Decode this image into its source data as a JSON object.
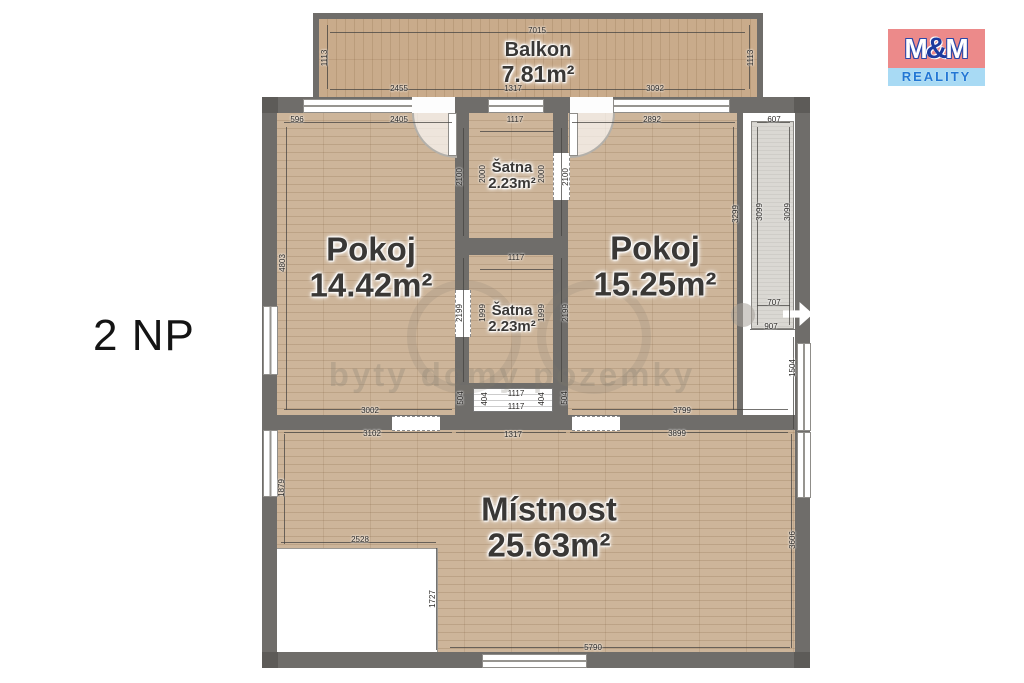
{
  "floor_label": "2 NP",
  "logo": {
    "m1": "M",
    "amp": "&",
    "m2": "M",
    "reality": "REALITY"
  },
  "watermark": "byty domy pozemky",
  "rooms": {
    "balkon": {
      "name": "Balkon",
      "area": "7.81m²"
    },
    "pokoj_left": {
      "name": "Pokoj",
      "area": "14.42m²"
    },
    "satna_top": {
      "name": "Šatna",
      "area": "2.23m²"
    },
    "satna_bottom": {
      "name": "Šatna",
      "area": "2.23m²"
    },
    "pokoj_right": {
      "name": "Pokoj",
      "area": "15.25m²"
    },
    "mistnost": {
      "name": "Místnost",
      "area": "25.63m²"
    }
  },
  "colors": {
    "wall": "#6f6d6a",
    "wood": "#cdb59a",
    "balcony_wood": "#c9ab8b",
    "shaft": "#dad8d3",
    "logo_pink": "#ec8a8a",
    "logo_blue": "#a8daf4",
    "logo_text_blue": "#2277d4"
  },
  "dimensions": [
    {
      "text": "7015",
      "x": 537,
      "y": 31,
      "o": "h"
    },
    {
      "text": "1113",
      "x": 325,
      "y": 58,
      "o": "v"
    },
    {
      "text": "1113",
      "x": 751,
      "y": 58,
      "o": "v"
    },
    {
      "text": "2455",
      "x": 399,
      "y": 89,
      "o": "h"
    },
    {
      "text": "1317",
      "x": 513,
      "y": 89,
      "o": "h"
    },
    {
      "text": "3092",
      "x": 655,
      "y": 89,
      "o": "h"
    },
    {
      "text": "596",
      "x": 297,
      "y": 120,
      "o": "h"
    },
    {
      "text": "2405",
      "x": 399,
      "y": 120,
      "o": "h"
    },
    {
      "text": "1117",
      "x": 515,
      "y": 120,
      "o": "h"
    },
    {
      "text": "2892",
      "x": 652,
      "y": 120,
      "o": "h"
    },
    {
      "text": "607",
      "x": 774,
      "y": 120,
      "o": "h"
    },
    {
      "text": "4803",
      "x": 283,
      "y": 263,
      "o": "v"
    },
    {
      "text": "2100",
      "x": 460,
      "y": 177,
      "o": "v"
    },
    {
      "text": "2000",
      "x": 483,
      "y": 174,
      "o": "v"
    },
    {
      "text": "2000",
      "x": 542,
      "y": 174,
      "o": "v"
    },
    {
      "text": "2100",
      "x": 566,
      "y": 177,
      "o": "v"
    },
    {
      "text": "3299",
      "x": 736,
      "y": 214,
      "o": "v"
    },
    {
      "text": "3099",
      "x": 760,
      "y": 212,
      "o": "v"
    },
    {
      "text": "3099",
      "x": 788,
      "y": 212,
      "o": "v"
    },
    {
      "text": "1117",
      "x": 516,
      "y": 258,
      "o": "h"
    },
    {
      "text": "2199",
      "x": 460,
      "y": 313,
      "o": "v"
    },
    {
      "text": "1999",
      "x": 483,
      "y": 313,
      "o": "v"
    },
    {
      "text": "1999",
      "x": 542,
      "y": 313,
      "o": "v"
    },
    {
      "text": "2199",
      "x": 566,
      "y": 313,
      "o": "v"
    },
    {
      "text": "707",
      "x": 774,
      "y": 303,
      "o": "h"
    },
    {
      "text": "907",
      "x": 771,
      "y": 327,
      "o": "h"
    },
    {
      "text": "1504",
      "x": 793,
      "y": 368,
      "o": "v"
    },
    {
      "text": "504",
      "x": 461,
      "y": 398,
      "o": "v"
    },
    {
      "text": "404",
      "x": 485,
      "y": 399,
      "o": "v"
    },
    {
      "text": "1117",
      "x": 516,
      "y": 394,
      "o": "h"
    },
    {
      "text": "1117",
      "x": 516,
      "y": 407,
      "o": "h"
    },
    {
      "text": "404",
      "x": 542,
      "y": 399,
      "o": "v"
    },
    {
      "text": "504",
      "x": 565,
      "y": 398,
      "o": "v"
    },
    {
      "text": "3002",
      "x": 370,
      "y": 411,
      "o": "h"
    },
    {
      "text": "3799",
      "x": 682,
      "y": 411,
      "o": "h"
    },
    {
      "text": "3102",
      "x": 372,
      "y": 434,
      "o": "h"
    },
    {
      "text": "1317",
      "x": 513,
      "y": 435,
      "o": "h"
    },
    {
      "text": "3899",
      "x": 677,
      "y": 434,
      "o": "h"
    },
    {
      "text": "1879",
      "x": 282,
      "y": 488,
      "o": "v"
    },
    {
      "text": "3606",
      "x": 793,
      "y": 540,
      "o": "v"
    },
    {
      "text": "2528",
      "x": 360,
      "y": 540,
      "o": "h"
    },
    {
      "text": "1727",
      "x": 433,
      "y": 599,
      "o": "v"
    },
    {
      "text": "5790",
      "x": 593,
      "y": 648,
      "o": "h"
    }
  ],
  "layout": {
    "dim_lines": [
      {
        "x": 330,
        "y": 32,
        "w": 415,
        "h": 1
      },
      {
        "x": 330,
        "y": 89,
        "w": 415,
        "h": 1
      },
      {
        "x": 327,
        "y": 25,
        "w": 1,
        "h": 64
      },
      {
        "x": 749,
        "y": 25,
        "w": 1,
        "h": 64
      },
      {
        "x": 284,
        "y": 122,
        "w": 168,
        "h": 1
      },
      {
        "x": 572,
        "y": 122,
        "w": 163,
        "h": 1
      },
      {
        "x": 757,
        "y": 122,
        "w": 33,
        "h": 1
      },
      {
        "x": 286,
        "y": 127,
        "w": 1,
        "h": 283
      },
      {
        "x": 733,
        "y": 127,
        "w": 1,
        "h": 283
      },
      {
        "x": 757,
        "y": 127,
        "w": 1,
        "h": 198
      },
      {
        "x": 789,
        "y": 127,
        "w": 1,
        "h": 198
      },
      {
        "x": 757,
        "y": 305,
        "w": 33,
        "h": 1
      },
      {
        "x": 750,
        "y": 329,
        "w": 45,
        "h": 1
      },
      {
        "x": 793,
        "y": 337,
        "w": 1,
        "h": 92
      },
      {
        "x": 463,
        "y": 128,
        "w": 1,
        "h": 108
      },
      {
        "x": 561,
        "y": 128,
        "w": 1,
        "h": 108
      },
      {
        "x": 463,
        "y": 258,
        "w": 1,
        "h": 124
      },
      {
        "x": 561,
        "y": 258,
        "w": 1,
        "h": 124
      },
      {
        "x": 480,
        "y": 131,
        "w": 74,
        "h": 1
      },
      {
        "x": 480,
        "y": 269,
        "w": 74,
        "h": 1
      },
      {
        "x": 284,
        "y": 409,
        "w": 168,
        "h": 1
      },
      {
        "x": 572,
        "y": 409,
        "w": 216,
        "h": 1
      },
      {
        "x": 284,
        "y": 432,
        "w": 168,
        "h": 1
      },
      {
        "x": 456,
        "y": 432,
        "w": 110,
        "h": 1
      },
      {
        "x": 570,
        "y": 432,
        "w": 218,
        "h": 1
      },
      {
        "x": 284,
        "y": 434,
        "w": 1,
        "h": 110
      },
      {
        "x": 791,
        "y": 434,
        "w": 1,
        "h": 214
      },
      {
        "x": 281,
        "y": 542,
        "w": 155,
        "h": 1
      },
      {
        "x": 436,
        "y": 548,
        "w": 1,
        "h": 102
      },
      {
        "x": 450,
        "y": 647,
        "w": 340,
        "h": 1
      }
    ]
  }
}
